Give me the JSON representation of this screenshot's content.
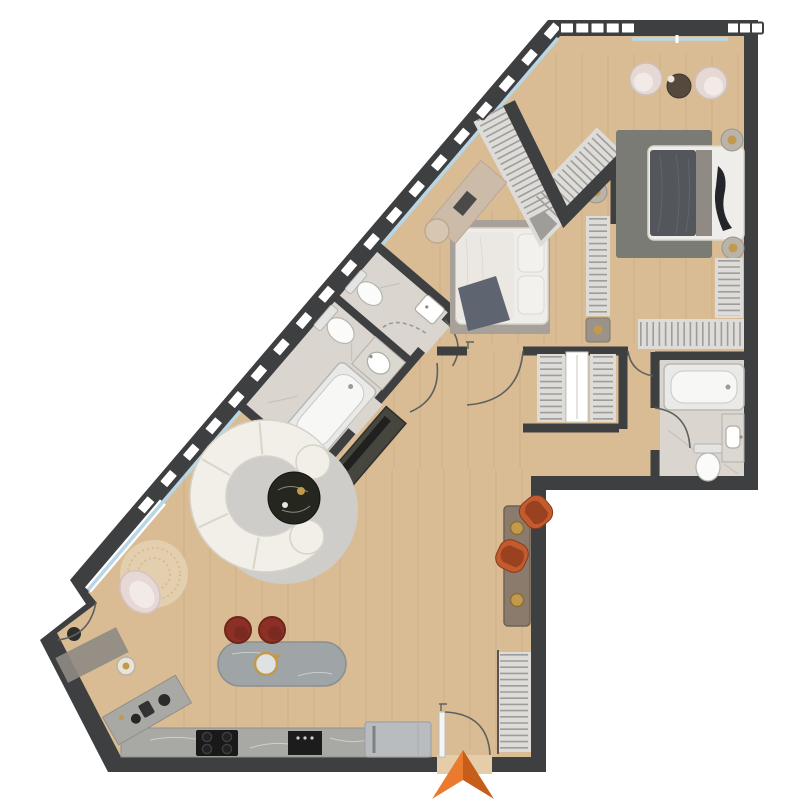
{
  "page": {
    "title": "apartment-floor-plan",
    "background": "#ffffff"
  },
  "palette": {
    "wood": "#d9bc93",
    "wood_light": "#e4cda8",
    "wall": "#3e3f40",
    "glass": "#b9d6e6",
    "tile": "#dad5cf",
    "tile_streak": "#c4beb5",
    "rug_master": "#797b74",
    "rug_bed2": "#a7a19a",
    "rug_living": "#cecdc9",
    "rug_round": "#e3cfad",
    "sofa": "#f1efe8",
    "sofa_seam": "#d9d5ca",
    "coffee_table": "#25271f",
    "accent_orange": "#c25b2d",
    "accent_orange_dark": "#9a4220",
    "stool_red": "#8c3026",
    "island": "#9fa4a7",
    "counter": "#a8a8a5",
    "steel": "#b9bcbf",
    "appliance_black": "#191919",
    "closet_base": "#dedcd8",
    "closet_stripe": "#9e9d99",
    "door_arc": "#5f6060",
    "brass": "#c29a4c",
    "console_taupe": "#8a7b6c",
    "bed_dark": "#53565b",
    "bed_frame": "#efede9",
    "pillow_gray": "#8f8a84",
    "throw_dark": "#23252a",
    "desk": "#cdbbaa",
    "blush": "#e6d9d5",
    "blush_light": "#f1eae6",
    "arrow": "#ea7a2e",
    "arrow_dark": "#c65e1a",
    "bath_white": "#f7f7f5",
    "mat_gray": "#8e8a84",
    "tv_dark": "#46463f"
  },
  "decor": {
    "diagonal_railing": {
      "x1": 80,
      "y1": 582,
      "x2": 552,
      "y2": 31,
      "t_start": 0.14,
      "count": 19,
      "block_w": 17,
      "block_h": 11,
      "angle": -49.4
    },
    "top_railings": [
      {
        "y": 28,
        "x1": 567,
        "x2": 628,
        "count": 5,
        "block_w": 14,
        "block_h": 11
      },
      {
        "y": 28,
        "x1": 733,
        "x2": 757,
        "count": 3,
        "block_w": 12,
        "block_h": 11
      }
    ],
    "planks": {
      "step": 26,
      "color": "#8a6a42",
      "opacity": 0.13,
      "regions": [
        [
          184,
          470,
          528,
          750
        ],
        [
          342,
          302,
          436,
          468
        ],
        [
          442,
          352,
          532,
          468
        ],
        [
          440,
          212,
          544,
          344
        ],
        [
          556,
          54,
          744,
          344
        ]
      ]
    }
  },
  "rooms": {
    "master_bedroom": {
      "furniture": [
        "double-bed",
        "area-rug",
        "nightstand-lamp",
        "nightstand-lamp",
        "armchair",
        "armchair",
        "round-side-table",
        "l-shaped-wardrobe"
      ]
    },
    "bedroom_2": {
      "furniture": [
        "double-bed",
        "area-rug",
        "wardrobe",
        "desk",
        "pouf",
        "nightstand-lamp",
        "nightstand-lamp"
      ]
    },
    "walk_in_closet": {
      "furniture": [
        "chevron-wardrobe"
      ]
    },
    "bathroom_main": {
      "furniture": [
        "bathtub",
        "toilet",
        "vanity-sink"
      ]
    },
    "wc": {
      "furniture": [
        "toilet",
        "hand-basin",
        "shower-screen"
      ]
    },
    "master_bathroom": {
      "furniture": [
        "bathtub",
        "toilet",
        "vanity-sink"
      ]
    },
    "living_room": {
      "furniture": [
        "curved-sofa",
        "round-coffee-table",
        "round-rug",
        "accent-chair",
        "accent-chair",
        "lounge-chair",
        "round-jute-rug",
        "floor-lamp",
        "tv-console"
      ]
    },
    "kitchen": {
      "furniture": [
        "island-with-sink",
        "bar-stool",
        "bar-stool",
        "cooktop",
        "oven-module",
        "fridge",
        "corner-counter",
        "coffee-machine"
      ]
    },
    "hallway": {
      "furniture": [
        "console-table",
        "wardrobe",
        "wardrobe",
        "mirror-slot"
      ]
    },
    "entry": {
      "furniture": [
        "entrance-door",
        "wardrobe",
        "door-mat"
      ],
      "arrow_icon": "entry-arrow"
    }
  }
}
